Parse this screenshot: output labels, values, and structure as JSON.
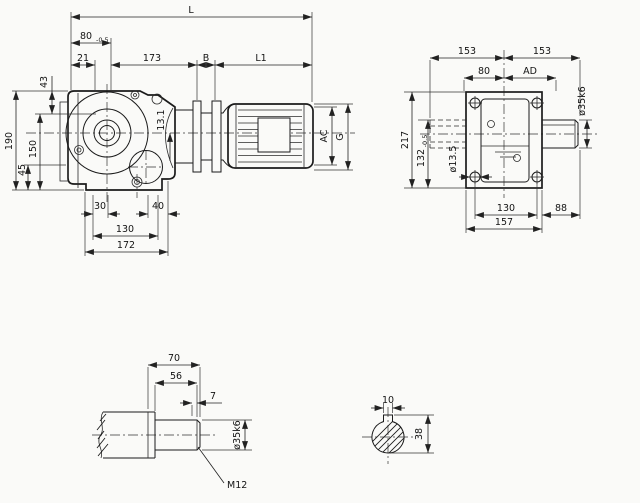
{
  "drawing": {
    "title": "gear-reducer-dimension-drawing",
    "background": "#fafaf8",
    "line_color": "#1b1b1b",
    "side_view": {
      "L": "L",
      "len_80": "80",
      "len_80_tol": "-0.5",
      "len_21": "21",
      "len_173": "173",
      "B": "B",
      "L1": "L1",
      "h_43": "43",
      "h_190": "190",
      "h_150": "150",
      "h_45": "45",
      "off_13_1": "13.1",
      "w_30": "30",
      "w_40": "40",
      "w_130": "130",
      "w_172": "172",
      "AC": "AC",
      "G": "G"
    },
    "front_view": {
      "w_153_left": "153",
      "w_153_right": "153",
      "w_80": "80",
      "AD": "AD",
      "h_217": "217",
      "h_132": "132",
      "h_132_tol": "-0.5",
      "hole_dia": "ø13.5",
      "shaft_dia": "ø35k6",
      "w_130": "130",
      "w_88": "88",
      "w_157": "157"
    },
    "shaft_detail": {
      "len_70": "70",
      "len_56": "56",
      "len_7": "7",
      "dia": "ø35k6",
      "thread": "M12"
    },
    "shaft_section": {
      "key_w": "10",
      "h_38": "38"
    }
  }
}
